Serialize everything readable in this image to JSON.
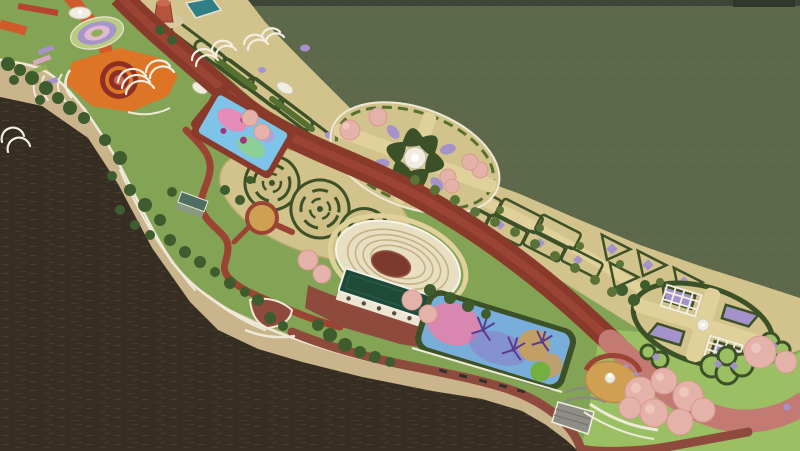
{
  "scene": {
    "type": "3d-architectural-render",
    "subject": "aerial-view-riverfront-park-master-plan"
  },
  "features": [
    "river-water",
    "grass-field",
    "stone-embankment",
    "main-boulevard",
    "orange-plaza",
    "terraced-circle-garden",
    "pergola-trellises",
    "hedge-maze-gardens",
    "sports-pool",
    "swirl-parterre-garden",
    "radial-parterre-garden",
    "garden-plots",
    "amphitheater",
    "pavilion-building",
    "splash-pond",
    "promenade",
    "fountain-plaza",
    "pergola-oval-garden",
    "scallop-flower-beds",
    "cherry-tree-clusters",
    "garden-hut",
    "red-tower"
  ],
  "palette": {
    "field": "#5e684a",
    "horizon": "#3f4438",
    "horizon_object": "#33362c",
    "water": "#362e23",
    "embankment": "#c9b48c",
    "wall": "#efe9d8",
    "lawn": "#84a455",
    "lawn_light": "#9bbf63",
    "garden_ground": "#d2c28b",
    "path_tan": "#e0d09a",
    "hedge": "#3c5128",
    "hedge_light": "#55702f",
    "shrub_dark": "#3f5c2e",
    "shrub_olive": "#5a7337",
    "road": "#8a3a2b",
    "road_median": "#9c4434",
    "road_salmon": "#c27a72",
    "promenade": "#8f4a3e",
    "orange_path": "#cf5a2a",
    "red_path": "#b5452e",
    "plaza_orange": "#dd7426",
    "plaza_ring_maroon": "#8e2f23",
    "plaza_gold": "#cf9f52",
    "plaza_red": "#8f4a3e",
    "pink_tree": "#e5b2aa",
    "flower_purple": "#a493cb",
    "flower_pink": "#d8a8c0",
    "pool_blue": "#7ec3e8",
    "pool_pink": "#e48bb8",
    "pool_green": "#8fd18c",
    "pool_purple": "#b39ddb",
    "pool_magenta": "#a2337f",
    "pond_blue": "#79aeda",
    "pond_pink": "#d887b0",
    "pond_purple": "#8f7cc9",
    "pond_tan": "#c2a065",
    "pond_green": "#72b13e",
    "pond_tree": "#5b3d8f",
    "amphi_ring": "#e8dfc3",
    "amphi_seat": "#c4b285",
    "stage": "#7c3a2e",
    "roof_green": "#1f4a3a",
    "building_wall": "#ece5d2",
    "pergola": "#f3efe2",
    "fountain": "#f0ece0",
    "steps_gray": "#8e8e86",
    "tower": "#b4543c",
    "tower_base": "#d8c9a0",
    "hut_roof": "#4e6e64",
    "hut_wall": "#8a9a80",
    "water_teal": "#2e7f86",
    "ring_outer": "#b9cd80",
    "ring_purple": "#a795c9",
    "ring_pink": "#dfb9cf",
    "ring_center": "#8fae5a",
    "bench": "#2f2f2f"
  }
}
